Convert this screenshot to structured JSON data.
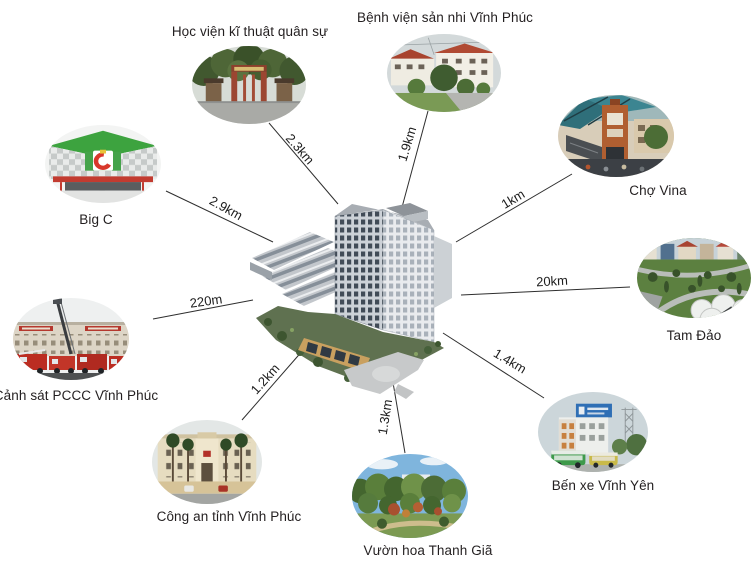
{
  "diagram": {
    "type": "location-distance-map",
    "center": {
      "photo": "apartment-complex-3d-render"
    },
    "colors": {
      "line": "#2e2e2e",
      "text": "#231f20",
      "background": "#ffffff"
    }
  },
  "landmarks": [
    {
      "id": "hoc-vien-ki-thuat-quan-su",
      "label": "Học viện kĩ thuật quân sự",
      "distance": "2.3km",
      "photo": "military-academy-gate"
    },
    {
      "id": "benh-vien-san-nhi-vinh-phuc",
      "label": "Bệnh viện sản nhi Vĩnh Phúc",
      "distance": "1.9km",
      "photo": "hospital-red-roof-buildings"
    },
    {
      "id": "cho-vina",
      "label": "Chợ Vina",
      "distance": "1km",
      "photo": "market-entrance-gate"
    },
    {
      "id": "tam-dao",
      "label": "Tam Đảo",
      "distance": "20km",
      "photo": "hill-town-square"
    },
    {
      "id": "ben-xe-vinh-yen",
      "label": "Bến xe Vĩnh Yên",
      "distance": "1.4km",
      "photo": "bus-station-building"
    },
    {
      "id": "vuon-hoa-thanh-gia",
      "label": "Vườn hoa Thanh Giã",
      "distance": "1.3km",
      "photo": "flower-park-garden"
    },
    {
      "id": "cong-an-tinh-vinh-phuc",
      "label": "Công an tỉnh Vĩnh Phúc",
      "distance": "1.2km",
      "photo": "provincial-police-headquarters"
    },
    {
      "id": "canh-sat-pccc-vinh-phuc",
      "label": "Cảnh sát PCCC Vĩnh Phúc",
      "distance": "220m",
      "photo": "fire-police-station-trucks"
    },
    {
      "id": "big-c",
      "label": "Big C",
      "distance": "2.9km",
      "photo": "big-c-supermarket"
    }
  ]
}
